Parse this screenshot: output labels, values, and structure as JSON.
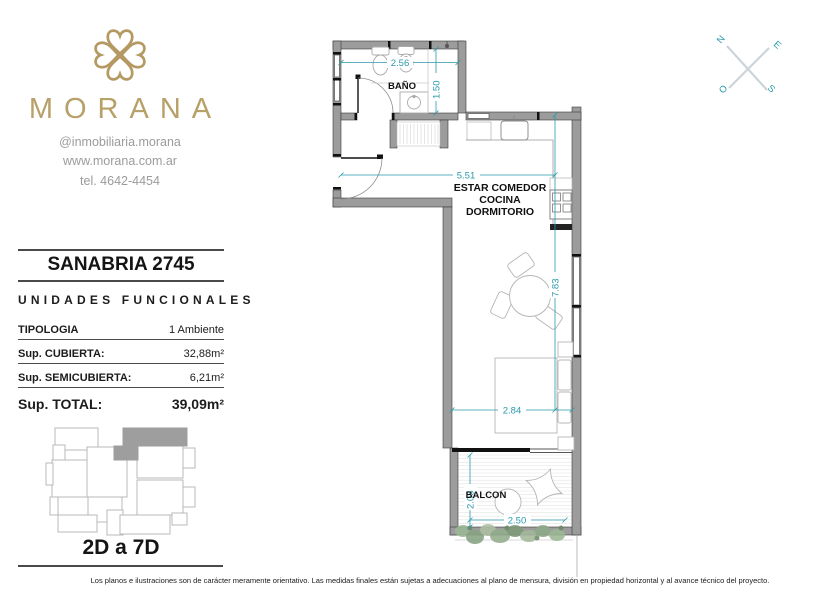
{
  "brand": {
    "name": "MORANA",
    "instagram": "@inmobiliaria.morana",
    "website": "www.morana.com.ar",
    "phone": "tel. 4642-4454"
  },
  "panel": {
    "title": "SANABRIA 2745",
    "subtitle": "UNIDADES FUNCIONALES",
    "rows": [
      {
        "label": "TIPOLOGIA",
        "value": "1 Ambiente"
      },
      {
        "label": "Sup. CUBIERTA:",
        "value": "32,88m²"
      },
      {
        "label": "Sup. SEMICUBIERTA:",
        "value": "6,21m²"
      },
      {
        "label": "Sup. TOTAL:",
        "value": "39,09m²"
      }
    ],
    "units_range": "2D a 7D"
  },
  "floorplan": {
    "labels": {
      "bathroom": "BAÑO",
      "living_line1": "ESTAR COMEDOR",
      "living_line2": "COCINA",
      "living_line3": "DORMITORIO",
      "balcony": "BALCON"
    },
    "dimensions": {
      "bath_width": "2.56",
      "bath_depth": "1.50",
      "living_width": "5.51",
      "living_length": "7.83",
      "bed_width": "2.84",
      "balcony_depth": "2.08",
      "balcony_width": "2.50"
    }
  },
  "compass": {
    "north": "N",
    "east": "E",
    "south": "S",
    "west": "O"
  },
  "disclaimer": "Los planos e ilustraciones son de carácter meramente orientativo. Las medidas finales están sujetas a adecuaciones al plano de mensura, división en propiedad horizontal y al avance técnico del proyecto.",
  "colors": {
    "accent_teal": "#2a9aab",
    "brand_gold": "#b7a169",
    "wall_gray": "#9c9c9c",
    "plant_green": "#8fa989"
  }
}
